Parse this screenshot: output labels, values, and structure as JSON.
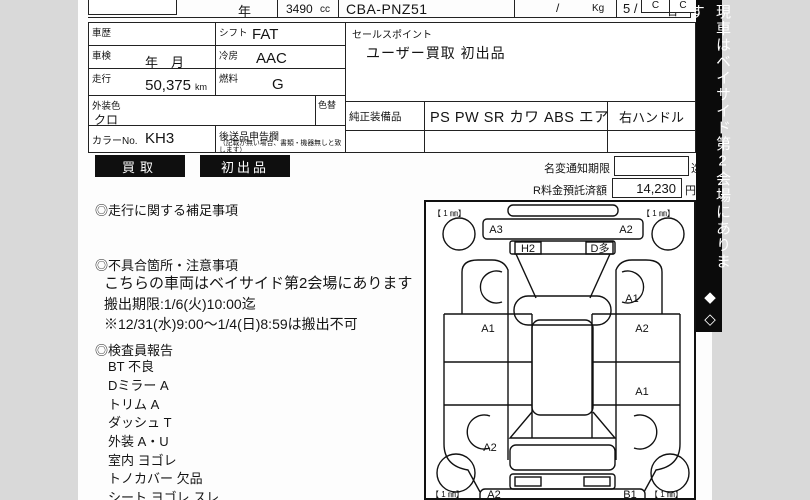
{
  "colors": {
    "bg": "#d9d9d9",
    "paper": "#ffffff",
    "ink": "#141414",
    "banner_bg": "#0b0b0b",
    "badge_bg": "#0f0f0f"
  },
  "top_row": {
    "year_label": "年",
    "displacement": "3490",
    "cc_label": "cc",
    "model_code": "CBA-PNZ51",
    "slash": "/",
    "kg_label": "Kg",
    "capacity": "5 /",
    "persons_label": "名",
    "grade_boxes": [
      "C",
      "C"
    ]
  },
  "info_table": {
    "history_label": "車歴",
    "history_value": "",
    "shift_label": "シフト",
    "shift_value": "FAT",
    "inspection_label": "車検",
    "inspection_value": "年　月",
    "ac_label": "冷房",
    "ac_value": "AAC",
    "mileage_label": "走行",
    "mileage_value": "50,375",
    "mileage_unit": "km",
    "fuel_label": "燃料",
    "fuel_value": "G",
    "ext_color_label": "外装色",
    "ext_color_value": "クロ",
    "repaint_label": "色替",
    "color_no_label": "カラーNo.",
    "color_no_value": "KH3",
    "later_items_label": "後送品申告欄",
    "later_items_note": "（記載が無い場合、書類・機器無しと致します）"
  },
  "sales_point": {
    "label": "セールスポイント",
    "value": "ユーザー買取 初出品"
  },
  "equipment": {
    "label": "純正装備品",
    "value": "PS PW SR カワ ABS エアB",
    "steering": "右ハンドル"
  },
  "badges": [
    "買取",
    "初出品"
  ],
  "fees": {
    "name_change_label": "名変通知期限",
    "name_change_value": "",
    "name_change_suffix": "迄",
    "recycle_label": "R料金預託済額",
    "recycle_value": "14,230",
    "recycle_unit": "円"
  },
  "notes": {
    "mileage_notes_title": "◎走行に関する補足事項",
    "defects_title": "◎不具合箇所・注意事項",
    "defects_lines": [
      "こちらの車両はベイサイド第2会場にあります",
      "搬出期限:1/6(火)10:00迄",
      "※12/31(水)9:00〜1/4(日)8:59は搬出不可"
    ],
    "inspector_title": "◎検査員報告",
    "inspector_lines": [
      "BT 不良",
      "Dミラー A",
      "トリム A",
      "ダッシュ T",
      "外装 A・U",
      "室内 ヨゴレ",
      "トノカバー 欠品",
      "シート ヨゴレ スレ"
    ]
  },
  "banner": {
    "text": "現車はベイサイド第2会場にあります",
    "marks": "◆◇"
  },
  "diagram": {
    "corner_marks": [
      "【 1 ㎜】",
      "【 1 ㎜】",
      "【 1 ㎜】",
      "【 1 ㎜】"
    ],
    "labels": [
      {
        "text": "A3",
        "x": 70,
        "y": 31
      },
      {
        "text": "A2",
        "x": 200,
        "y": 31
      },
      {
        "text": "H2",
        "x": 102,
        "y": 50
      },
      {
        "text": "D多",
        "x": 174,
        "y": 50
      },
      {
        "text": "A1",
        "x": 206,
        "y": 100
      },
      {
        "text": "A1",
        "x": 62,
        "y": 130
      },
      {
        "text": "A2",
        "x": 216,
        "y": 130
      },
      {
        "text": "A1",
        "x": 216,
        "y": 193
      },
      {
        "text": "A2",
        "x": 64,
        "y": 249
      },
      {
        "text": "A2",
        "x": 68,
        "y": 296
      },
      {
        "text": "B1",
        "x": 204,
        "y": 296
      }
    ]
  }
}
